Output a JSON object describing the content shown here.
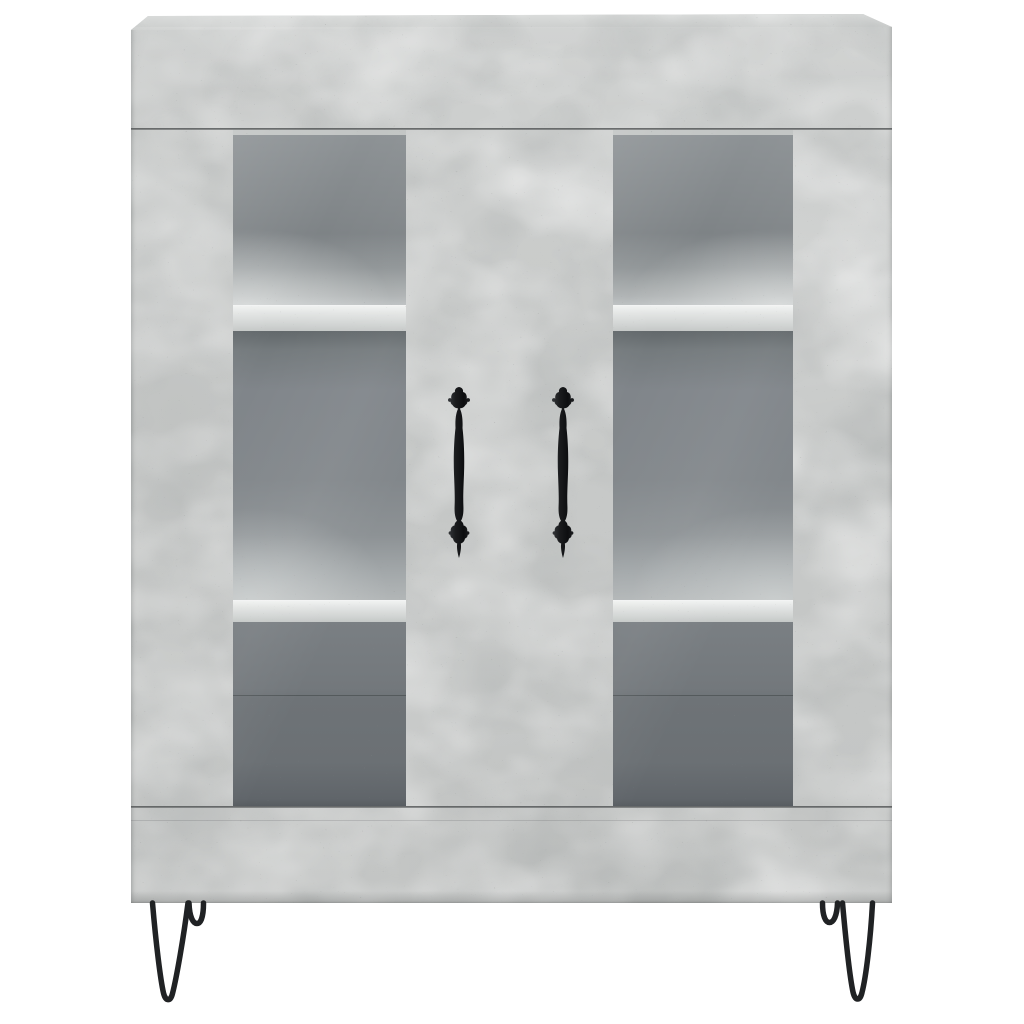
{
  "scene": {
    "type": "product-photo",
    "description": "Concrete grey sideboard highboard with two glass doors, three interior compartments per door, two ornate black vertical handles and black hairpin metal legs, on a plain white background",
    "background": "plain white studio background",
    "text_visible": "none"
  },
  "colors": {
    "background": "#ffffff",
    "concrete": "#c7c9c8",
    "concrete_top": "#d0d2d1",
    "shelf_edge": "#d2d5d4",
    "interior_dark": "#6e7377",
    "interior_mid": "#83888b",
    "seam": "#3c3f3e",
    "handle": "#17181a",
    "leg": "#202224"
  },
  "cabinet": {
    "finish": "concrete grey with speckled texture",
    "top_panel": "overhanging top board, seam below at top rail",
    "doors": [
      {
        "name": "left-door",
        "glass_panel": true,
        "handle_side": "right stile"
      },
      {
        "name": "right-door",
        "glass_panel": true,
        "handle_side": "left stile"
      }
    ],
    "handles": {
      "count": 2,
      "style": "ornate vintage vertical pull, black metal"
    },
    "shelves_visible_per_door": 2,
    "compartments_visible_per_door": 3,
    "center_gap": "full-height dark seam between the two door modules",
    "legs": {
      "style": "hairpin wire",
      "color": "black",
      "count_visible": 4,
      "front_legs": 2,
      "back_legs_partially_visible": 2
    }
  }
}
